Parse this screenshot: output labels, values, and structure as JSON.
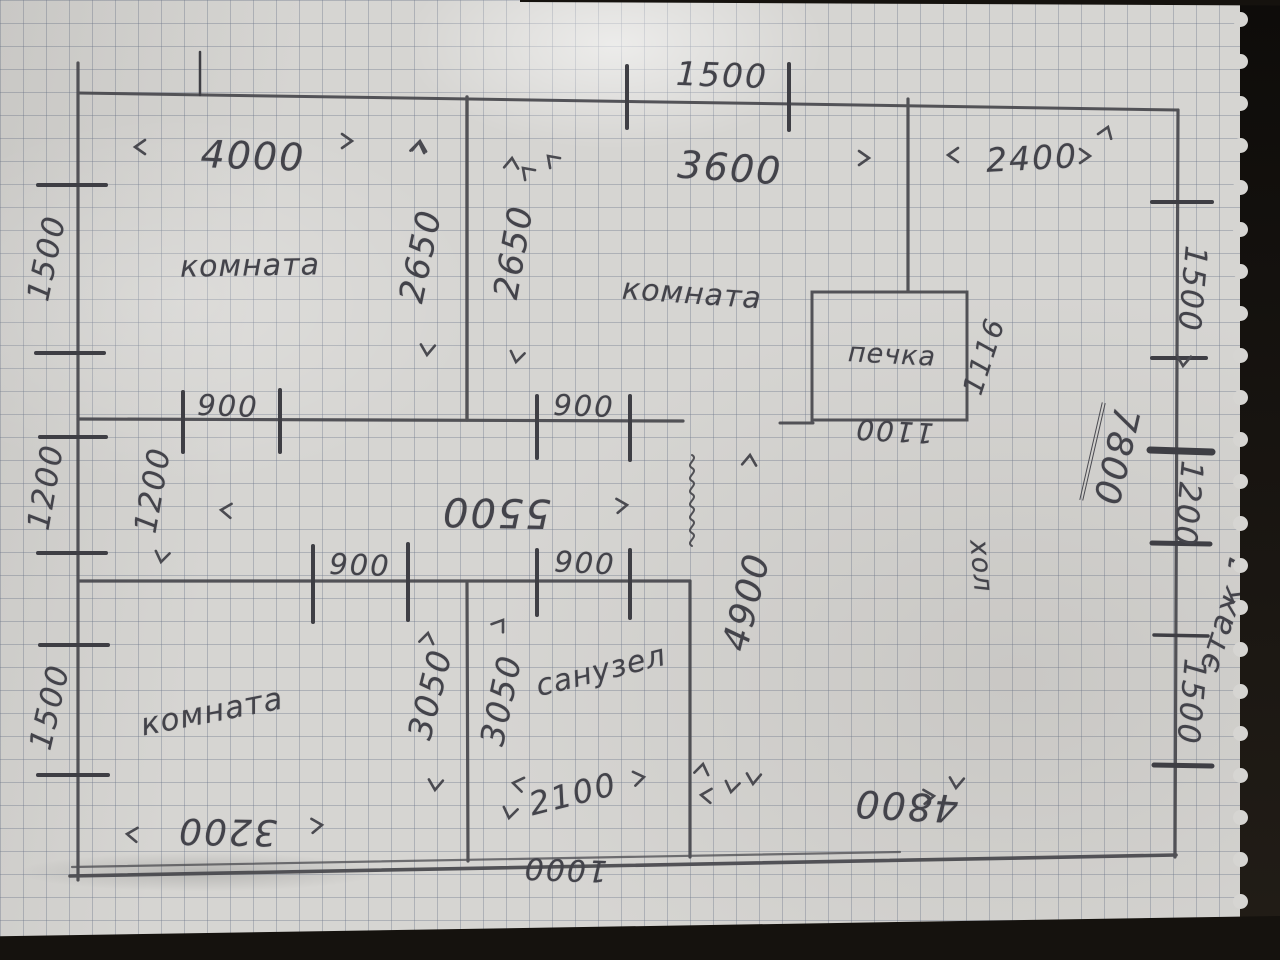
{
  "plan": {
    "rooms": {
      "top_left": "комната",
      "top_middle": "комната",
      "bottom_left": "комната",
      "bathroom": "санузел"
    },
    "stove_label": "печка",
    "hall_label": "хол",
    "floor_note": "этаж 1"
  },
  "dims": {
    "top_opening": "1500",
    "room_tl_width": "4000",
    "room_tl_depth": "2650",
    "room_tm_width": "3600",
    "room_tm_depth": "2650",
    "entry_width": "2400",
    "left_top": "1500",
    "left_middle": "1200",
    "left_bottom": "1500",
    "right_top": "1500",
    "right_middle": "1200",
    "right_bottom": "1500",
    "door_room_tl": "900",
    "door_room_tm": "900",
    "door_room_bl": "900",
    "door_bathroom": "900",
    "corridor_width": "1200",
    "corridor_length": "5500",
    "room_bl_width": "3200",
    "room_bl_depth": "3050",
    "bathroom_depth": "3050",
    "bathroom_width": "2100",
    "bottom_opening": "1000",
    "hall_width": "4800",
    "hall_depth": "4900",
    "hall_length": "7800",
    "stove_depth": "1116",
    "stove_width": "1100"
  }
}
